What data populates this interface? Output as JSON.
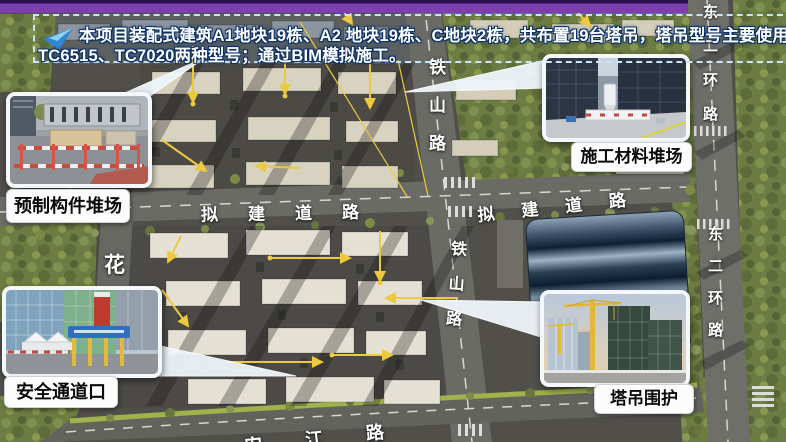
{
  "slide": {
    "top_bar_color": "#7d3fad",
    "banner": {
      "icon": "blue-arrow-icon",
      "line1": "本项目装配式建筑A1地块19栋、A2 地块19栋、C地块2栋，共布置19台塔吊，塔吊型号主要使用",
      "line2": "TC6515、TC7020两种型号；通过BIM模拟施工。",
      "border_color": "#c9e6f8",
      "text_color": "#ffffff"
    }
  },
  "map": {
    "labels": {
      "tieshan_upper": "铁山路",
      "tieshan_lower": "铁山路",
      "nijian_left": "拟建道路",
      "nijian_right": "拟建道路",
      "donghuan_upper": "东二环路",
      "donghuan_lower": "东二环路",
      "hua": "花",
      "anjiang": "安江路"
    },
    "accents": {
      "crane_line_color": "#ecc93f",
      "road_text_color": "#ffffff"
    }
  },
  "callouts": {
    "precast": {
      "label": "预制构件堆场"
    },
    "material": {
      "label": "施工材料堆场"
    },
    "safety": {
      "label": "安全通道口"
    },
    "crane": {
      "label": "塔吊围护"
    }
  }
}
